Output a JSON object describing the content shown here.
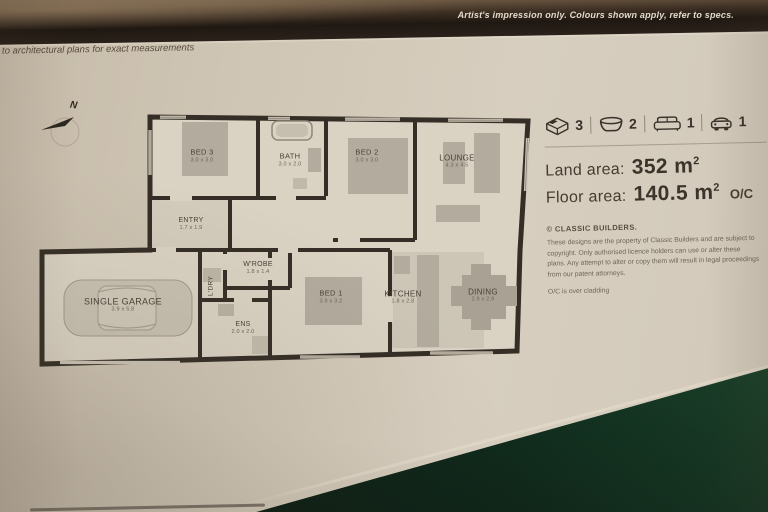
{
  "photo": {
    "artist_note": "Artist's impression only. Colours shown apply, refer to specs.",
    "measurements_note": "to architectural plans for exact measurements"
  },
  "plan": {
    "north_label": "N",
    "rooms": [
      {
        "name": "BED 3",
        "dims": "3.0 x 3.0"
      },
      {
        "name": "BATH",
        "dims": "3.0 x 2.0"
      },
      {
        "name": "BED 2",
        "dims": "3.0 x 3.0"
      },
      {
        "name": "LOUNGE",
        "dims": "4.3 x 4.5"
      },
      {
        "name": "ENTRY",
        "dims": "1.7 x 1.9"
      },
      {
        "name": "L'DRY",
        "dims": ""
      },
      {
        "name": "W'ROBE",
        "dims": "1.8 x 1.4"
      },
      {
        "name": "BED 1",
        "dims": "3.9 x 3.2"
      },
      {
        "name": "ENS",
        "dims": "2.0 x 2.0"
      },
      {
        "name": "KITCHEN",
        "dims": "1.8 x 2.8"
      },
      {
        "name": "DINING",
        "dims": "2.9 x 2.9"
      },
      {
        "name": "SINGLE GARAGE",
        "dims": "3.9 x 5.8"
      }
    ]
  },
  "summary": {
    "beds": "3",
    "baths": "2",
    "living": "1",
    "garages": "1",
    "land_label": "Land area:",
    "land_value": "352",
    "land_unit": "m",
    "land_sup": "2",
    "floor_label": "Floor area:",
    "floor_value": "140.5",
    "floor_unit": "m",
    "floor_sup": "2",
    "floor_suffix": "O/C"
  },
  "legal": {
    "title": "© CLASSIC BUILDERS.",
    "body": "These designs are the property of Classic Builders and are subject to copyright. Only authorised licence holders can use or alter these plans. Any attempt to alter or copy them will result in legal proceedings from our patent attorneys.",
    "note": "O/C is over cladding"
  },
  "colors": {
    "paper": "#cfc5b4",
    "wall": "#342e26",
    "furniture": "#b3ac9e",
    "table_green": "#1a4029",
    "band_dark": "#1f1812"
  }
}
